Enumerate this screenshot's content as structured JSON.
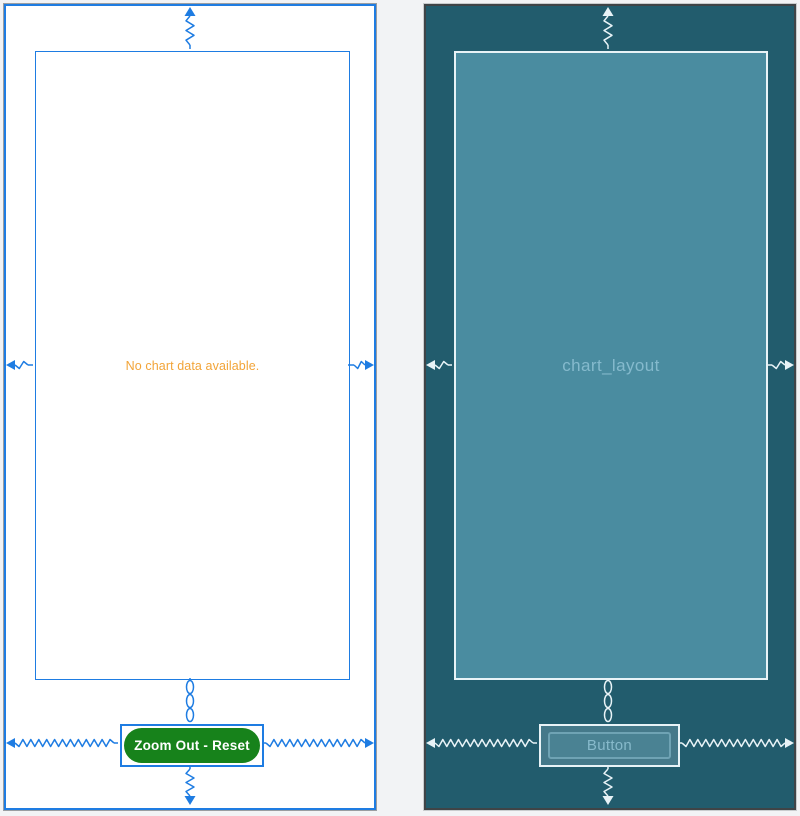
{
  "design_view": {
    "chart_placeholder_text": "No chart data available.",
    "button_label": "Zoom Out - Reset"
  },
  "blueprint_view": {
    "layout_id": "chart_layout",
    "button_label": "Button"
  },
  "colors": {
    "accent_blue": "#1E7CE2",
    "no_data_orange": "#F2A438",
    "button_green": "#17821B",
    "blueprint_background": "#225C6D",
    "blueprint_widget_fill": "#4A8CA0",
    "blueprint_line": "#E8F3F7"
  }
}
